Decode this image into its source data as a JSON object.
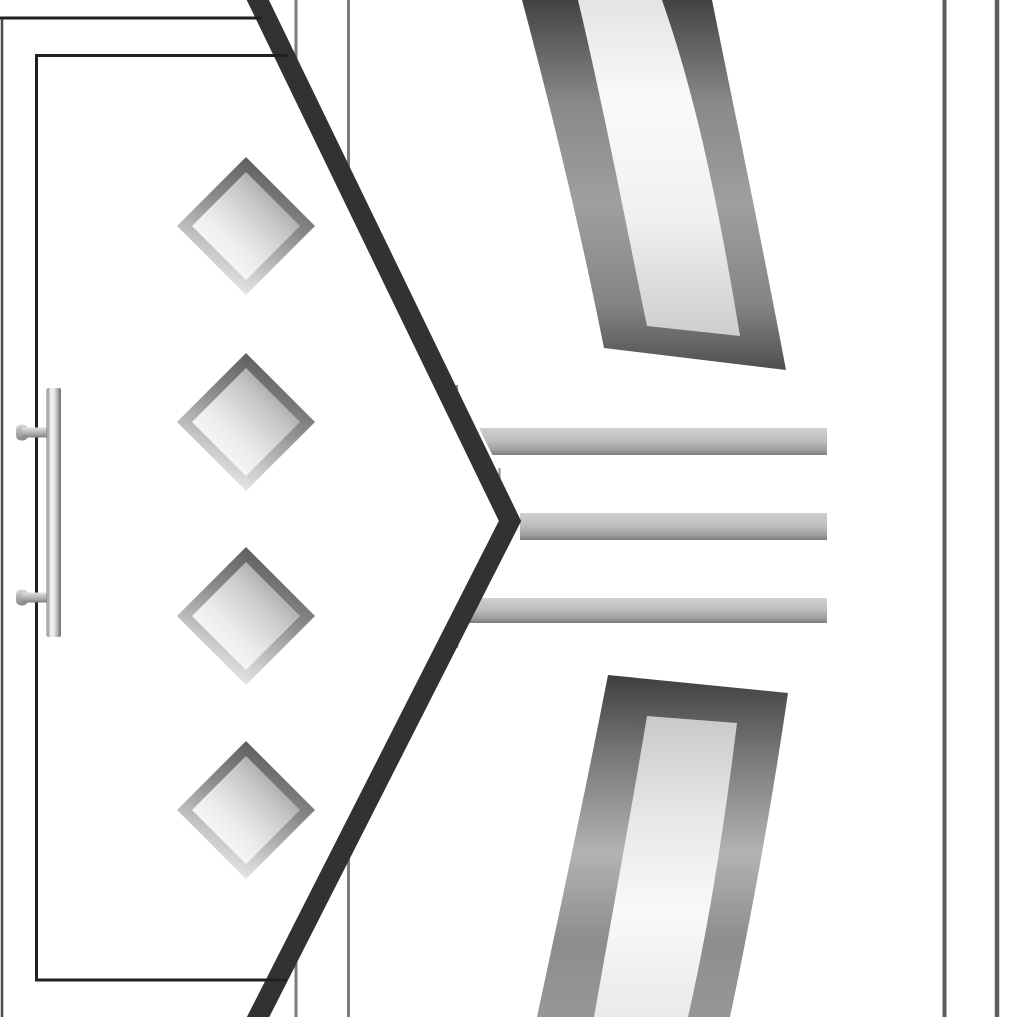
{
  "meta": {
    "title": "Close-up of two door design renderings separated by an angled chevron edge",
    "canvas": {
      "width": 1018,
      "height": 1017
    },
    "background": "#ffffff"
  },
  "left_door": {
    "name": "left-door-panel",
    "fill": "#ffffff",
    "mask_polygon": [
      [
        0,
        -12
      ],
      [
        252,
        -12
      ],
      [
        510,
        521
      ],
      [
        252,
        1029
      ],
      [
        0,
        1029
      ]
    ],
    "chevron_divider": {
      "name": "chevron-divider",
      "points": [
        [
          252,
          -12
        ],
        [
          510,
          521
        ],
        [
          252,
          1029
        ]
      ],
      "color": "#323232",
      "stroke_width": 20
    },
    "edges": [
      {
        "name": "door-top-edge",
        "type": "hline",
        "y": 18,
        "x1": 0,
        "x2": 262,
        "width": 3,
        "color": "#1f1f1f"
      },
      {
        "name": "door-left-edge",
        "type": "vline",
        "x": 2,
        "y1": 19,
        "y2": 1029,
        "width": 2.5,
        "color": "#4a4a4a"
      },
      {
        "name": "panel-frame-left",
        "type": "vline",
        "x": 36.5,
        "y1": 54,
        "y2": 981.5,
        "width": 3,
        "color": "#202020"
      },
      {
        "name": "panel-frame-top",
        "type": "hline",
        "y": 55.5,
        "x1": 35,
        "x2": 288,
        "width": 3,
        "color": "#202020"
      },
      {
        "name": "panel-frame-bottom",
        "type": "hline",
        "y": 980,
        "x1": 35,
        "x2": 287,
        "width": 3,
        "color": "#202020"
      }
    ],
    "diamonds": {
      "name": "diamond-glass-panel",
      "cx": 246,
      "half": 69,
      "inner_half": 54,
      "centers_y": [
        226,
        422,
        616,
        810
      ],
      "outer_gradient": [
        [
          0,
          "#565656"
        ],
        [
          0.4,
          "#8a8a8a"
        ],
        [
          0.75,
          "#c8c8c8"
        ],
        [
          1,
          "#efefef"
        ]
      ],
      "inner_gradient": [
        [
          0,
          "#ffffff"
        ],
        [
          0.35,
          "#ebebeb"
        ],
        [
          0.68,
          "#c9c9c9"
        ],
        [
          1,
          "#979797"
        ]
      ]
    },
    "handle": {
      "name": "door-handle",
      "bar": {
        "x": 46.5,
        "y": 388,
        "w": 14.5,
        "h": 249,
        "rx": 2
      },
      "bar_gradient": [
        [
          0,
          "#6f6f6f"
        ],
        [
          0.1,
          "#c6c6c6"
        ],
        [
          0.3,
          "#f2f2f2"
        ],
        [
          0.52,
          "#e9e9e9"
        ],
        [
          0.75,
          "#b4b4b4"
        ],
        [
          1,
          "#6b6b6b"
        ]
      ],
      "brackets_y": [
        427.5,
        592.5
      ],
      "bracket": {
        "x": 22,
        "w": 30,
        "h": 10
      },
      "bracket_gradient": [
        [
          0,
          "#e2e2e2"
        ],
        [
          0.55,
          "#b2b2b2"
        ],
        [
          1,
          "#7f7f7f"
        ]
      ],
      "cap": {
        "x": 16,
        "w": 12,
        "h": 16,
        "rx": 5
      },
      "cap_gradient": [
        [
          0,
          "#d9d9d9"
        ],
        [
          1,
          "#858585"
        ]
      ]
    }
  },
  "right_door": {
    "name": "right-door-panel",
    "frame_lines": [
      {
        "name": "right-door-frame-line-a",
        "x": 296,
        "y1": 0,
        "y2": 1017,
        "width": 3,
        "color": "#7c7c7c"
      },
      {
        "name": "right-door-frame-line-b",
        "x": 348.5,
        "y1": 0,
        "y2": 1017,
        "width": 3,
        "color": "#7c7c7c"
      },
      {
        "name": "right-door-frame-line-c",
        "x": 457,
        "y1": 385,
        "y2": 648,
        "width": 2.2,
        "color": "#8a8a8a"
      },
      {
        "name": "right-door-frame-line-d",
        "x": 499.5,
        "y1": 468,
        "y2": 560,
        "width": 2.2,
        "color": "#9a9a9a"
      },
      {
        "name": "right-door-frame-line-e",
        "x": 944.5,
        "y1": 0,
        "y2": 1017,
        "width": 4,
        "color": "#5e5e5e"
      },
      {
        "name": "right-door-frame-line-f",
        "x": 997,
        "y1": 0,
        "y2": 1017,
        "width": 4.5,
        "color": "#5e5e5e"
      }
    ],
    "stripes": {
      "name": "metallic-stripe",
      "gradient": [
        [
          0,
          "#d0d0d0"
        ],
        [
          0.5,
          "#bcbcbc"
        ],
        [
          0.82,
          "#9d9d9d"
        ],
        [
          1,
          "#7b7b7b"
        ]
      ],
      "items": [
        {
          "points": [
            [
              479,
              428
            ],
            [
              827,
              428
            ],
            [
              827,
              455
            ],
            [
              492.5,
              455
            ]
          ]
        },
        {
          "points": [
            [
              520,
              513
            ],
            [
              827,
              513
            ],
            [
              827,
              540
            ],
            [
              520,
              540
            ]
          ]
        },
        {
          "points": [
            [
              478,
              598
            ],
            [
              827,
              598
            ],
            [
              827,
              623
            ],
            [
              465.5,
              623
            ]
          ]
        }
      ]
    },
    "upper_band": {
      "name": "upper-curved-band",
      "outer_path": "M 522,0 C 558,135 584,248 604,348 L 786,370 C 763,248 736,118 712,0 Z",
      "inner_path": "M 578,0 C 606,118 629,240 647,326 L 740,336 C 722,228 700,108 662,0 Z",
      "outer_gradient": [
        [
          0,
          "#434343"
        ],
        [
          0.28,
          "#898989"
        ],
        [
          0.55,
          "#9f9f9f"
        ],
        [
          0.82,
          "#858585"
        ],
        [
          1,
          "#4f4f4f"
        ]
      ],
      "inner_gradient": [
        [
          0,
          "#e4e4e4"
        ],
        [
          0.3,
          "#fafafa"
        ],
        [
          0.65,
          "#f0f0f0"
        ],
        [
          1,
          "#cecece"
        ]
      ]
    },
    "lower_band": {
      "name": "lower-curved-band",
      "outer_path": "M 608,675 L 788,693 C 772,802 753,908 730,1017 L 537,1017 C 562,900 586,788 608,675 Z",
      "inner_path": "M 647,716 L 737,723 C 725,820 710,920 688,1017 L 594,1017 C 612,915 631,812 647,716 Z",
      "outer_gradient": [
        [
          0,
          "#3f3f3f"
        ],
        [
          0.22,
          "#757575"
        ],
        [
          0.52,
          "#b2b2b2"
        ],
        [
          0.78,
          "#8d8d8d"
        ],
        [
          1,
          "#979797"
        ]
      ],
      "inner_gradient": [
        [
          0,
          "#c9c9c9"
        ],
        [
          0.35,
          "#e8e8e8"
        ],
        [
          0.65,
          "#f9f9f9"
        ],
        [
          1,
          "#eaeaea"
        ]
      ]
    }
  }
}
